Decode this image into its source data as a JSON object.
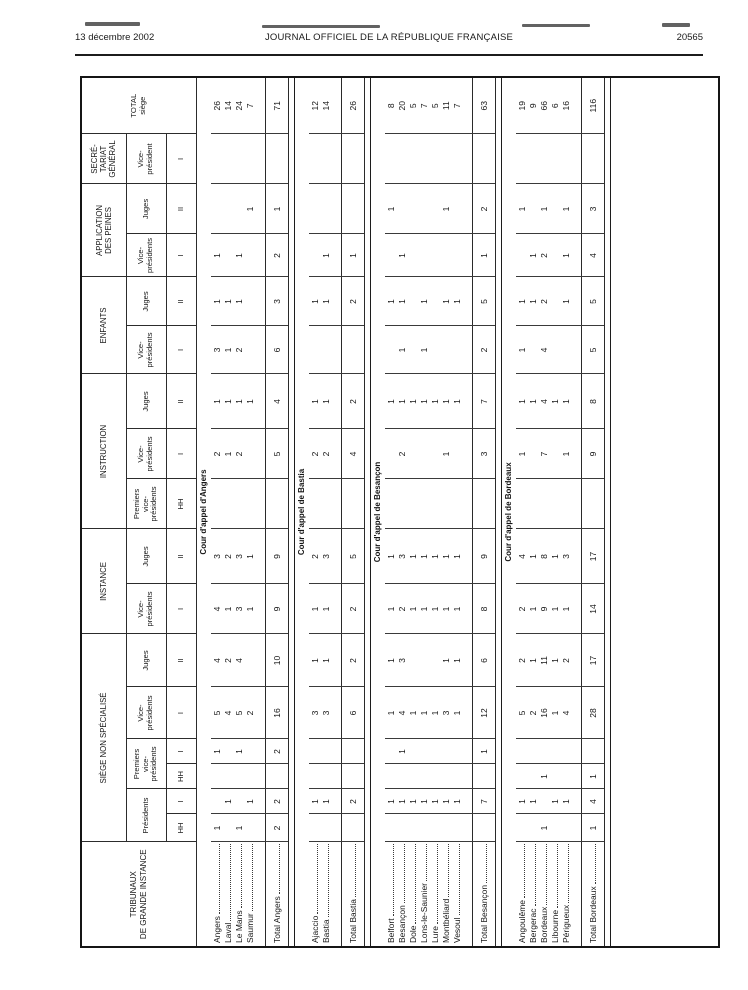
{
  "page_header": {
    "date": "13 décembre 2002",
    "journal_title": "JOURNAL OFFICIEL DE LA RÉPUBLIQUE FRANÇAISE",
    "page_number": "20565"
  },
  "table": {
    "stub_header": "TRIBUNAUX\nDE GRANDE INSTANCE",
    "total_header": "TOTAL\nsiège",
    "groups": [
      {
        "label": "SIÈGE NON SPÉCIALISÉ",
        "functions": [
          {
            "label": "Présidents",
            "grades": [
              "HH",
              "I"
            ]
          },
          {
            "label": "Premiers\nvice-\nprésidents",
            "grades": [
              "HH",
              "I"
            ]
          },
          {
            "label": "Vice-\nprésidents",
            "grades": [
              "I"
            ]
          },
          {
            "label": "Juges",
            "grades": [
              "II"
            ]
          }
        ]
      },
      {
        "label": "INSTANCE",
        "functions": [
          {
            "label": "Vice-\nprésidents",
            "grades": [
              "I"
            ]
          },
          {
            "label": "Juges",
            "grades": [
              "II"
            ]
          }
        ]
      },
      {
        "label": "INSTRUCTION",
        "functions": [
          {
            "label": "Premiers\nvice-\nprésidents",
            "grades": [
              "HH"
            ]
          },
          {
            "label": "Vice-\nprésidents",
            "grades": [
              "I"
            ]
          },
          {
            "label": "Juges",
            "grades": [
              "II"
            ]
          }
        ]
      },
      {
        "label": "ENFANTS",
        "functions": [
          {
            "label": "Vice-\nprésidents",
            "grades": [
              "I"
            ]
          },
          {
            "label": "Juges",
            "grades": [
              "II"
            ]
          }
        ]
      },
      {
        "label": "APPLICATION\nDES PEINES",
        "functions": [
          {
            "label": "Vice-\nprésidents",
            "grades": [
              "I"
            ]
          },
          {
            "label": "Juges",
            "grades": [
              "II"
            ]
          }
        ]
      },
      {
        "label": "SECRÉ-\nTARIAT\nGÉNÉRAL",
        "functions": [
          {
            "label": "Vice-\nprésident",
            "grades": [
              "I"
            ]
          }
        ]
      }
    ],
    "sections": [
      {
        "banner": "Cour d'appel d'Angers",
        "rows": [
          {
            "label": "Angers",
            "v": [
              "1",
              "",
              "",
              "1",
              "5",
              "4",
              "4",
              "3",
              "",
              "2",
              "1",
              "3",
              "1",
              "1",
              "",
              "",
              "26"
            ]
          },
          {
            "label": "Laval",
            "v": [
              "",
              "1",
              "",
              "",
              "4",
              "2",
              "1",
              "2",
              "",
              "1",
              "1",
              "1",
              "1",
              "",
              "",
              "",
              "14"
            ]
          },
          {
            "label": "Le Mans",
            "v": [
              "1",
              "",
              "",
              "1",
              "5",
              "4",
              "3",
              "3",
              "",
              "2",
              "1",
              "2",
              "1",
              "1",
              "",
              "",
              "24"
            ]
          },
          {
            "label": "Saumur",
            "v": [
              "",
              "1",
              "",
              "",
              "2",
              "",
              "1",
              "1",
              "",
              "",
              "1",
              "",
              "",
              "",
              "1",
              "",
              "7"
            ]
          }
        ],
        "total": {
          "label": "Total Angers",
          "v": [
            "2",
            "2",
            "",
            "2",
            "16",
            "10",
            "9",
            "9",
            "",
            "5",
            "4",
            "6",
            "3",
            "2",
            "1",
            "",
            "71"
          ]
        }
      },
      {
        "banner": "Cour d'appel de Bastia",
        "rows": [
          {
            "label": "Ajaccio",
            "v": [
              "",
              "1",
              "",
              "",
              "3",
              "1",
              "1",
              "2",
              "",
              "2",
              "1",
              "",
              "1",
              "",
              "",
              "",
              "12"
            ]
          },
          {
            "label": "Bastia",
            "v": [
              "",
              "1",
              "",
              "",
              "3",
              "1",
              "1",
              "3",
              "",
              "2",
              "1",
              "",
              "1",
              "1",
              "",
              "",
              "14"
            ]
          }
        ],
        "total": {
          "label": "Total Bastia",
          "v": [
            "",
            "2",
            "",
            "",
            "6",
            "2",
            "2",
            "5",
            "",
            "4",
            "2",
            "",
            "2",
            "1",
            "",
            "",
            "26"
          ]
        }
      },
      {
        "banner": "Cour d'appel de Besançon",
        "rows": [
          {
            "label": "Belfort",
            "v": [
              "",
              "1",
              "",
              "",
              "1",
              "1",
              "1",
              "1",
              "",
              "",
              "1",
              "",
              "1",
              "",
              "1",
              "",
              "8"
            ]
          },
          {
            "label": "Besançon",
            "v": [
              "",
              "1",
              "",
              "1",
              "4",
              "3",
              "2",
              "3",
              "",
              "2",
              "1",
              "1",
              "1",
              "1",
              "",
              "",
              "20"
            ]
          },
          {
            "label": "Dole",
            "v": [
              "",
              "1",
              "",
              "",
              "1",
              "",
              "1",
              "1",
              "",
              "",
              "1",
              "",
              "",
              "",
              "",
              "",
              "5"
            ]
          },
          {
            "label": "Lons-le-Saunier",
            "v": [
              "",
              "1",
              "",
              "",
              "1",
              "",
              "1",
              "1",
              "",
              "",
              "1",
              "1",
              "1",
              "",
              "",
              "",
              "7"
            ]
          },
          {
            "label": "Lure",
            "v": [
              "",
              "1",
              "",
              "",
              "1",
              "",
              "1",
              "1",
              "",
              "",
              "1",
              "",
              "",
              "",
              "",
              "",
              "5"
            ]
          },
          {
            "label": "Montbéliard",
            "v": [
              "",
              "1",
              "",
              "",
              "3",
              "1",
              "1",
              "1",
              "",
              "1",
              "1",
              "",
              "1",
              "",
              "1",
              "",
              "11"
            ]
          },
          {
            "label": "Vesoul",
            "v": [
              "",
              "1",
              "",
              "",
              "1",
              "1",
              "1",
              "1",
              "",
              "",
              "1",
              "",
              "1",
              "",
              "",
              "",
              "7"
            ]
          }
        ],
        "total": {
          "label": "Total Besançon",
          "v": [
            "",
            "7",
            "",
            "1",
            "12",
            "6",
            "8",
            "9",
            "",
            "3",
            "7",
            "2",
            "5",
            "1",
            "2",
            "",
            "63"
          ]
        }
      },
      {
        "banner": "Cour d'appel de Bordeaux",
        "rows": [
          {
            "label": "Angoulême",
            "v": [
              "",
              "1",
              "",
              "",
              "5",
              "2",
              "2",
              "4",
              "",
              "1",
              "1",
              "1",
              "1",
              "",
              "1",
              "",
              "19"
            ]
          },
          {
            "label": "Bergerac",
            "v": [
              "",
              "1",
              "",
              "",
              "2",
              "1",
              "1",
              "1",
              "",
              "",
              "1",
              "",
              "1",
              "1",
              "",
              "",
              "9"
            ]
          },
          {
            "label": "Bordeaux",
            "v": [
              "1",
              "",
              "1",
              "",
              "16",
              "11",
              "9",
              "8",
              "",
              "7",
              "4",
              "4",
              "2",
              "2",
              "1",
              "",
              "66"
            ]
          },
          {
            "label": "Libourne",
            "v": [
              "",
              "1",
              "",
              "",
              "1",
              "1",
              "1",
              "1",
              "",
              "",
              "1",
              "",
              "",
              "",
              "",
              "",
              "6"
            ]
          },
          {
            "label": "Périgueux",
            "v": [
              "",
              "1",
              "",
              "",
              "4",
              "2",
              "1",
              "3",
              "",
              "1",
              "1",
              "",
              "1",
              "1",
              "1",
              "",
              "16"
            ]
          }
        ],
        "total": {
          "label": "Total Bordeaux",
          "v": [
            "1",
            "4",
            "1",
            "",
            "28",
            "17",
            "14",
            "17",
            "",
            "9",
            "8",
            "5",
            "5",
            "4",
            "3",
            "",
            "116"
          ]
        }
      }
    ]
  }
}
